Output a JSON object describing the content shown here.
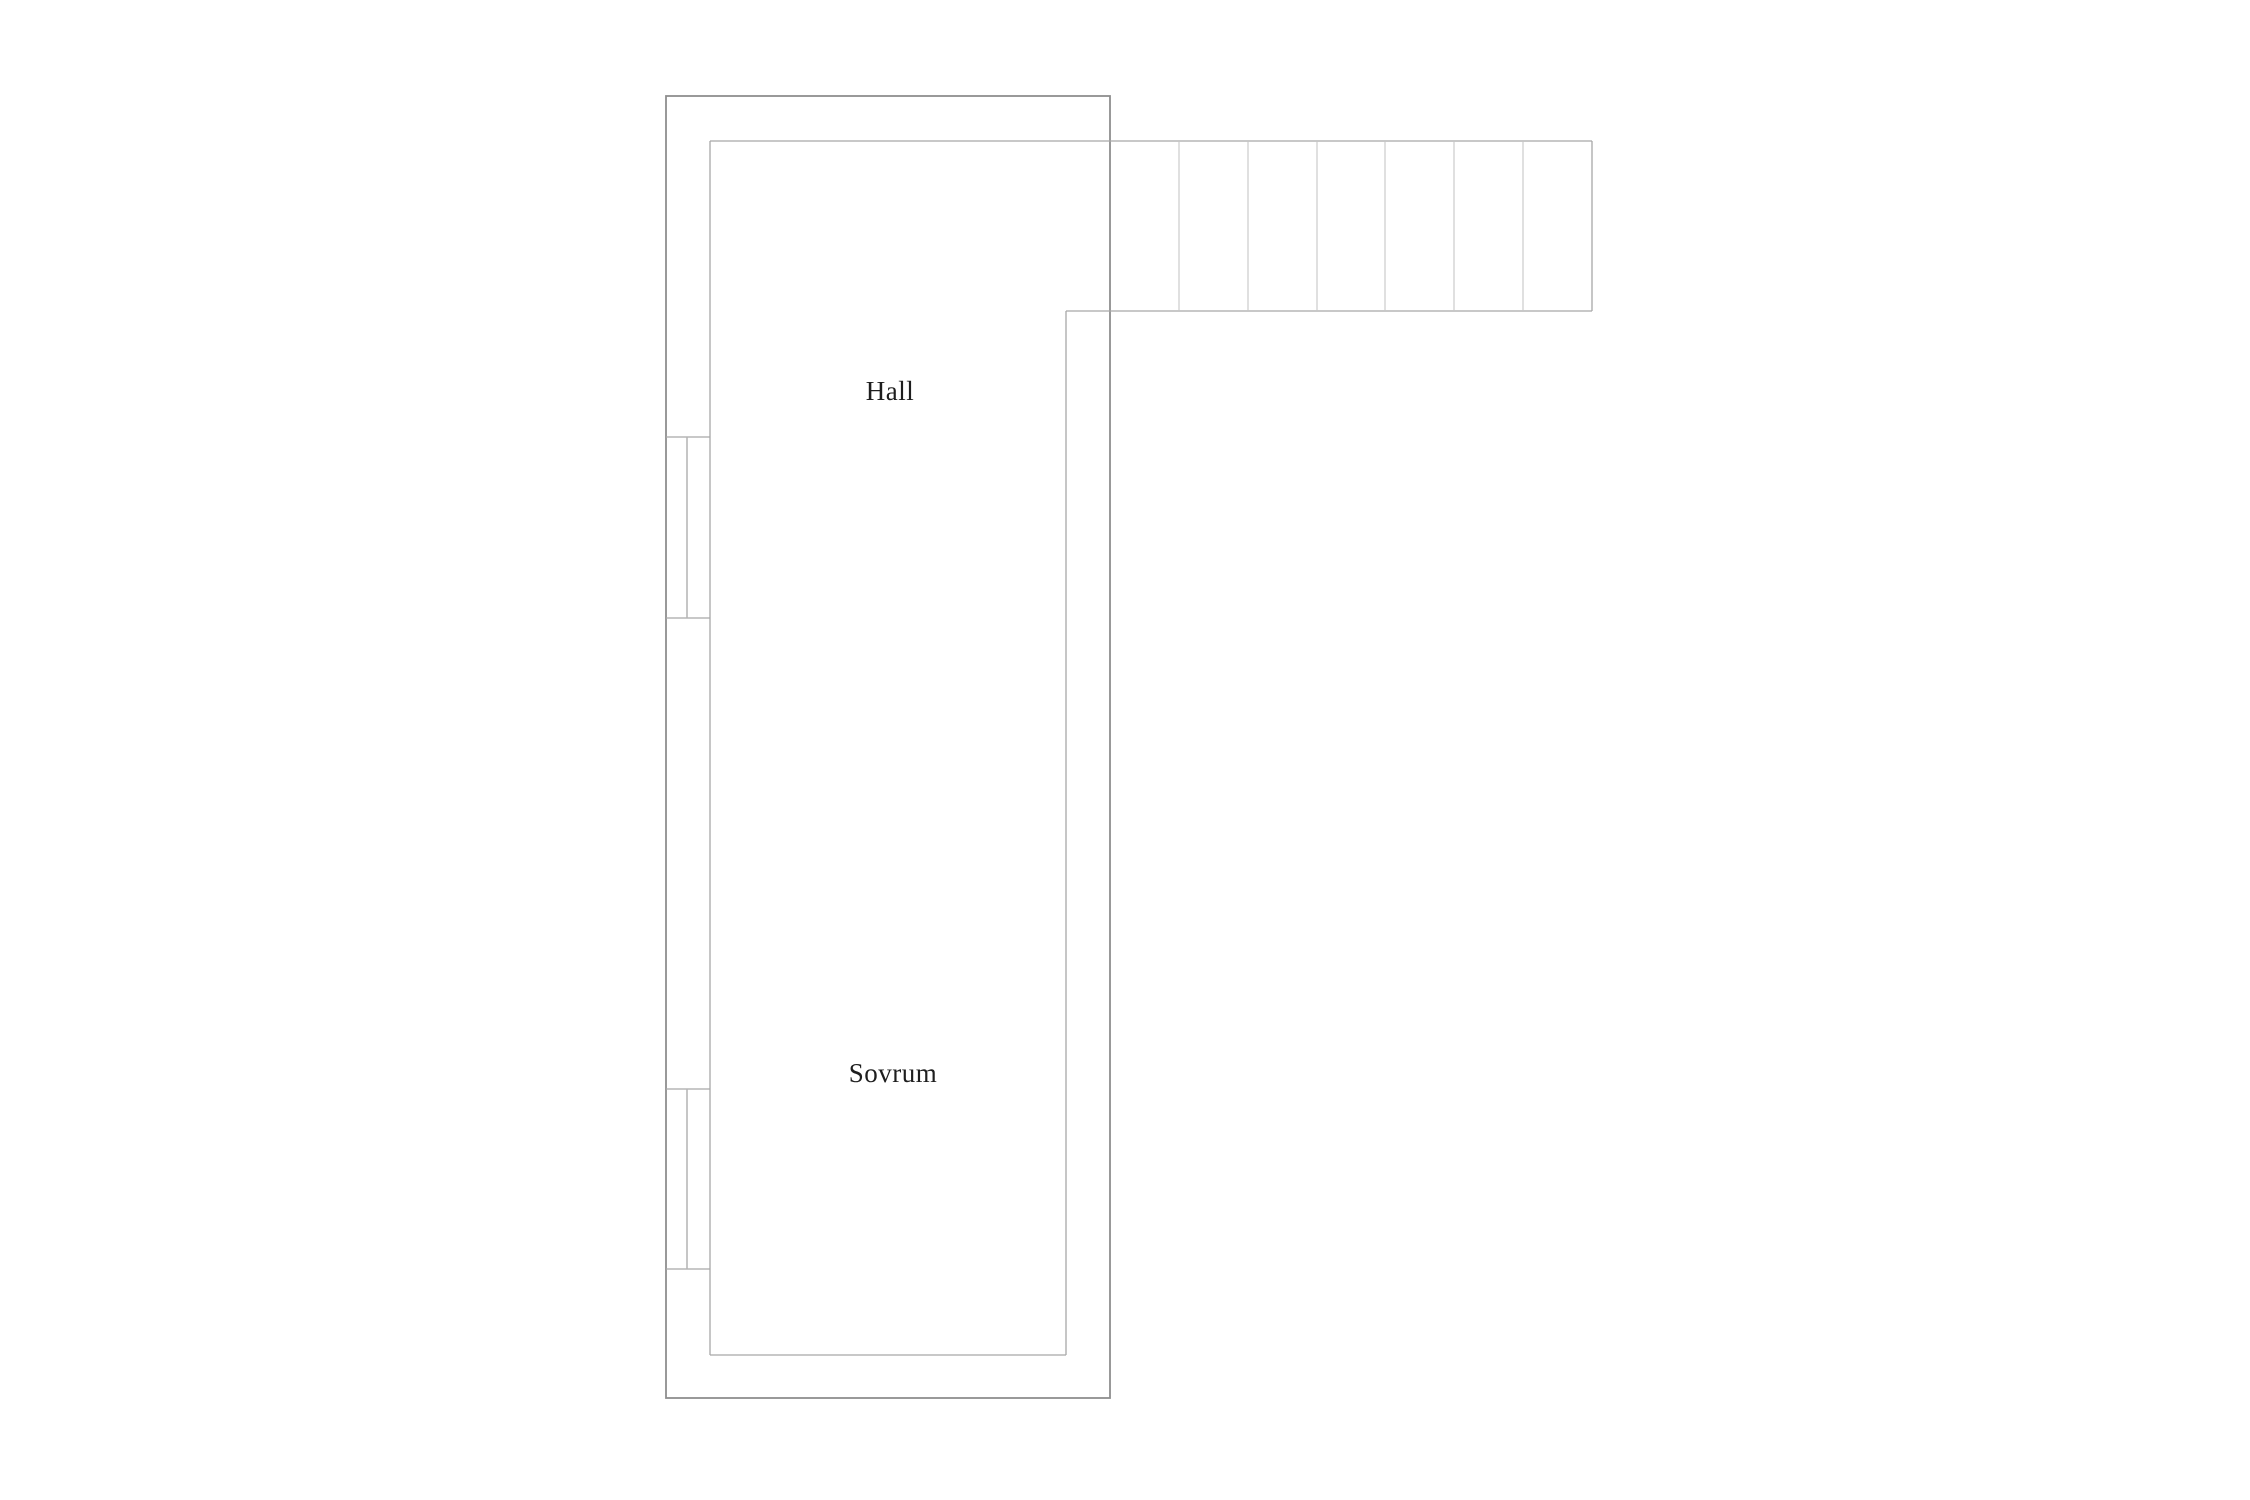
{
  "floorplan": {
    "canvas": {
      "width": 2250,
      "height": 1500,
      "background": "#ffffff"
    },
    "colors": {
      "outer_wall": "#8e8e8e",
      "inner_wall": "#a8a8a8",
      "stair_tread": "#c6c6c6",
      "window_pane": "#b4b4b4",
      "label_text": "#1e1e1e"
    },
    "stroke_widths": {
      "outer": 1.8,
      "inner": 1.3,
      "tread": 1.1,
      "pane": 1.5
    },
    "outer_wall_rect": {
      "x": 666,
      "y": 96,
      "width": 444,
      "height": 1302
    },
    "lines": [
      {
        "kind": "inner",
        "name": "inner-top-and-stair-top-wall",
        "x1": 710,
        "y1": 141,
        "x2": 1592,
        "y2": 141
      },
      {
        "kind": "inner",
        "name": "inner-left-wall",
        "x1": 710,
        "y1": 141,
        "x2": 710,
        "y2": 1355
      },
      {
        "kind": "inner",
        "name": "inner-bottom-wall",
        "x1": 710,
        "y1": 1355,
        "x2": 1066,
        "y2": 1355
      },
      {
        "kind": "inner",
        "name": "inner-right-wall",
        "x1": 1066,
        "y1": 311,
        "x2": 1066,
        "y2": 1355
      },
      {
        "kind": "inner",
        "name": "stair-bottom-wall",
        "x1": 1066,
        "y1": 311,
        "x2": 1592,
        "y2": 311
      },
      {
        "kind": "inner",
        "name": "stair-right-wall",
        "x1": 1592,
        "y1": 141,
        "x2": 1592,
        "y2": 311
      },
      {
        "kind": "tread",
        "name": "stair-tread-line-1",
        "x1": 1179,
        "y1": 141,
        "x2": 1179,
        "y2": 311
      },
      {
        "kind": "tread",
        "name": "stair-tread-line-2",
        "x1": 1248,
        "y1": 141,
        "x2": 1248,
        "y2": 311
      },
      {
        "kind": "tread",
        "name": "stair-tread-line-3",
        "x1": 1317,
        "y1": 141,
        "x2": 1317,
        "y2": 311
      },
      {
        "kind": "tread",
        "name": "stair-tread-line-4",
        "x1": 1385,
        "y1": 141,
        "x2": 1385,
        "y2": 311
      },
      {
        "kind": "tread",
        "name": "stair-tread-line-5",
        "x1": 1454,
        "y1": 141,
        "x2": 1454,
        "y2": 311
      },
      {
        "kind": "tread",
        "name": "stair-tread-line-6",
        "x1": 1523,
        "y1": 141,
        "x2": 1523,
        "y2": 311
      },
      {
        "kind": "inner",
        "name": "window-1-top-line",
        "x1": 666,
        "y1": 437,
        "x2": 710,
        "y2": 437
      },
      {
        "kind": "inner",
        "name": "window-1-bottom-line",
        "x1": 666,
        "y1": 618,
        "x2": 710,
        "y2": 618
      },
      {
        "kind": "pane",
        "name": "window-1-pane-line",
        "x1": 687,
        "y1": 437,
        "x2": 687,
        "y2": 618
      },
      {
        "kind": "inner",
        "name": "window-2-top-line",
        "x1": 666,
        "y1": 1089,
        "x2": 710,
        "y2": 1089
      },
      {
        "kind": "inner",
        "name": "window-2-bottom-line",
        "x1": 666,
        "y1": 1269,
        "x2": 710,
        "y2": 1269
      },
      {
        "kind": "pane",
        "name": "window-2-pane-line",
        "x1": 687,
        "y1": 1089,
        "x2": 687,
        "y2": 1269
      }
    ],
    "stairs": {
      "region": {
        "x1": 1110,
        "y1": 141,
        "x2": 1592,
        "y2": 311
      },
      "tread_count": 7
    },
    "labels": [
      {
        "id": "hall",
        "text": "Hall",
        "x": 890,
        "y": 400,
        "font_size": 27
      },
      {
        "id": "sovrum",
        "text": "Sovrum",
        "x": 893,
        "y": 1082,
        "font_size": 27
      }
    ]
  }
}
